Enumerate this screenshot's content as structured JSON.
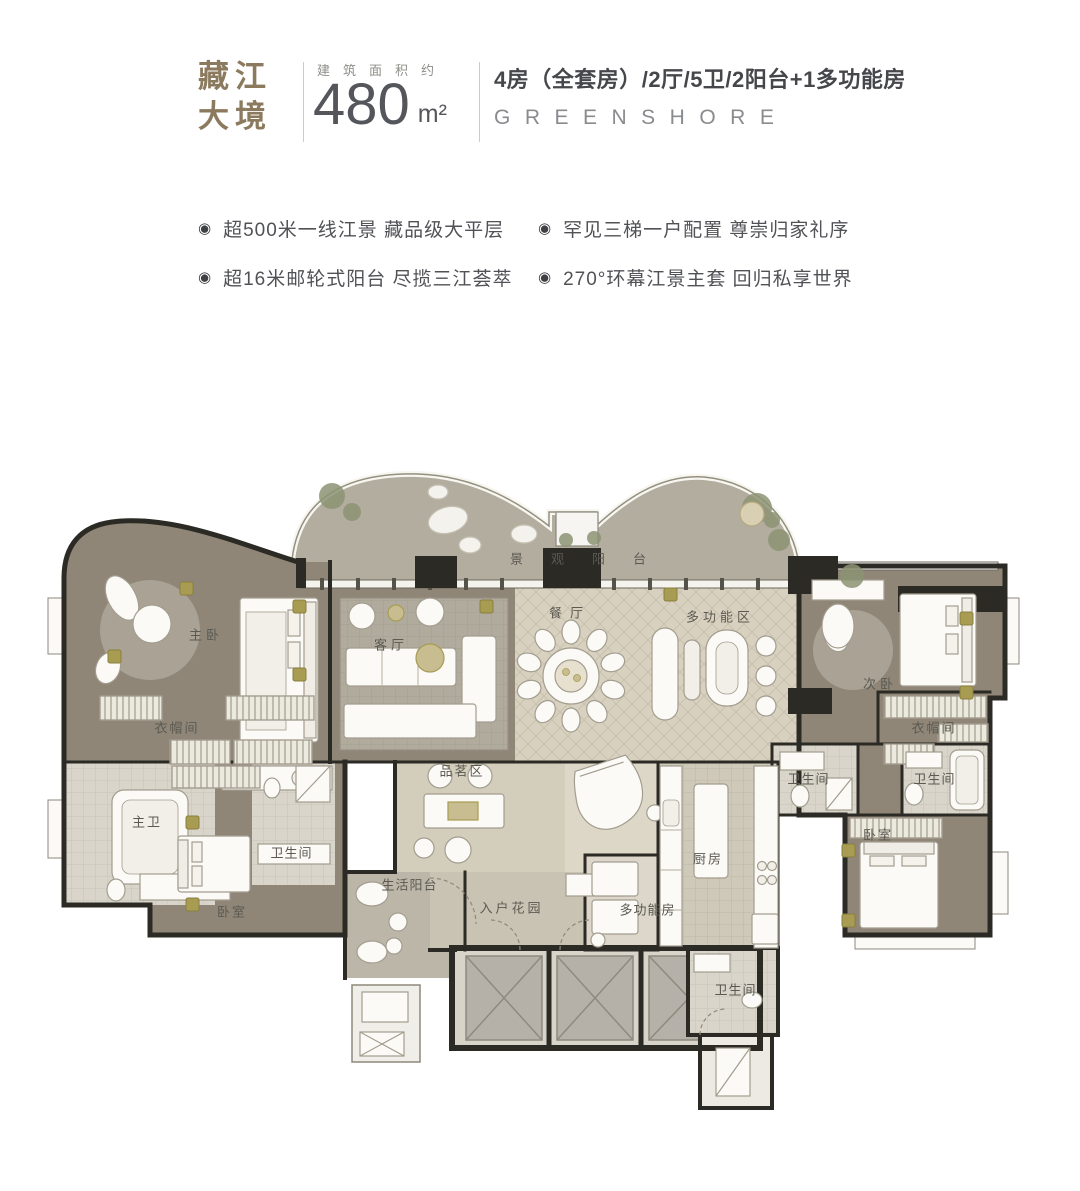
{
  "header": {
    "brand_line1": "藏江",
    "brand_line2": "大境",
    "area_label": "建筑面积约",
    "area_value": "480",
    "area_unit": "m²",
    "layout_line": "4房（全套房）/2厅/5卫/2阳台+1多功能房",
    "english_name": "GREENSHORE",
    "brand_color": "#8c7a5e",
    "heading_color": "#46474b",
    "sub_color": "#8a8b8f"
  },
  "bullet_glyph": "◉",
  "highlights": [
    "超500米一线江景  藏品级大平层",
    "罕见三梯一户配置  尊崇归家礼序",
    "超16米邮轮式阳台  尽揽三江荟萃",
    "270°环幕江景主套  回归私享世界"
  ],
  "floorplan": {
    "accent_gold": "#a79c52",
    "wall_color": "#2b2a25",
    "wood_floor": "#8f8678",
    "stone_floor": "#b3ada0",
    "hall_floor": "#d8d1c0",
    "bath_floor": "#d9d5cb",
    "rooms": [
      {
        "label": "景观阳台",
        "x": 578,
        "y": 558,
        "ls": 28
      },
      {
        "label": "主卧",
        "x": 204,
        "y": 634,
        "ls": 4
      },
      {
        "label": "客厅",
        "x": 389,
        "y": 644,
        "ls": 4
      },
      {
        "label": "餐厅",
        "x": 566,
        "y": 612,
        "ls": 8
      },
      {
        "label": "多功能区",
        "x": 718,
        "y": 616,
        "ls": 4
      },
      {
        "label": "次卧",
        "x": 878,
        "y": 683,
        "ls": 4
      },
      {
        "label": "衣帽间",
        "x": 176,
        "y": 727,
        "ls": 2
      },
      {
        "label": "衣帽间",
        "x": 933,
        "y": 727,
        "ls": 2
      },
      {
        "label": "主卫",
        "x": 146,
        "y": 821,
        "ls": 2
      },
      {
        "label": "卫生间",
        "x": 291,
        "y": 852,
        "ls": 1
      },
      {
        "label": "卫生间",
        "x": 808,
        "y": 778,
        "ls": 1
      },
      {
        "label": "卫生间",
        "x": 934,
        "y": 778,
        "ls": 1
      },
      {
        "label": "卧室",
        "x": 231,
        "y": 911,
        "ls": 2
      },
      {
        "label": "卧室",
        "x": 877,
        "y": 834,
        "ls": 2
      },
      {
        "label": "品茗区",
        "x": 461,
        "y": 770,
        "ls": 2
      },
      {
        "label": "厨房",
        "x": 707,
        "y": 858,
        "ls": 2
      },
      {
        "label": "生活阳台",
        "x": 409,
        "y": 884,
        "ls": 1
      },
      {
        "label": "入户花园",
        "x": 510,
        "y": 907,
        "ls": 3
      },
      {
        "label": "多功能房",
        "x": 647,
        "y": 909,
        "ls": 1
      },
      {
        "label": "卫生间",
        "x": 735,
        "y": 989,
        "ls": 1
      }
    ]
  }
}
